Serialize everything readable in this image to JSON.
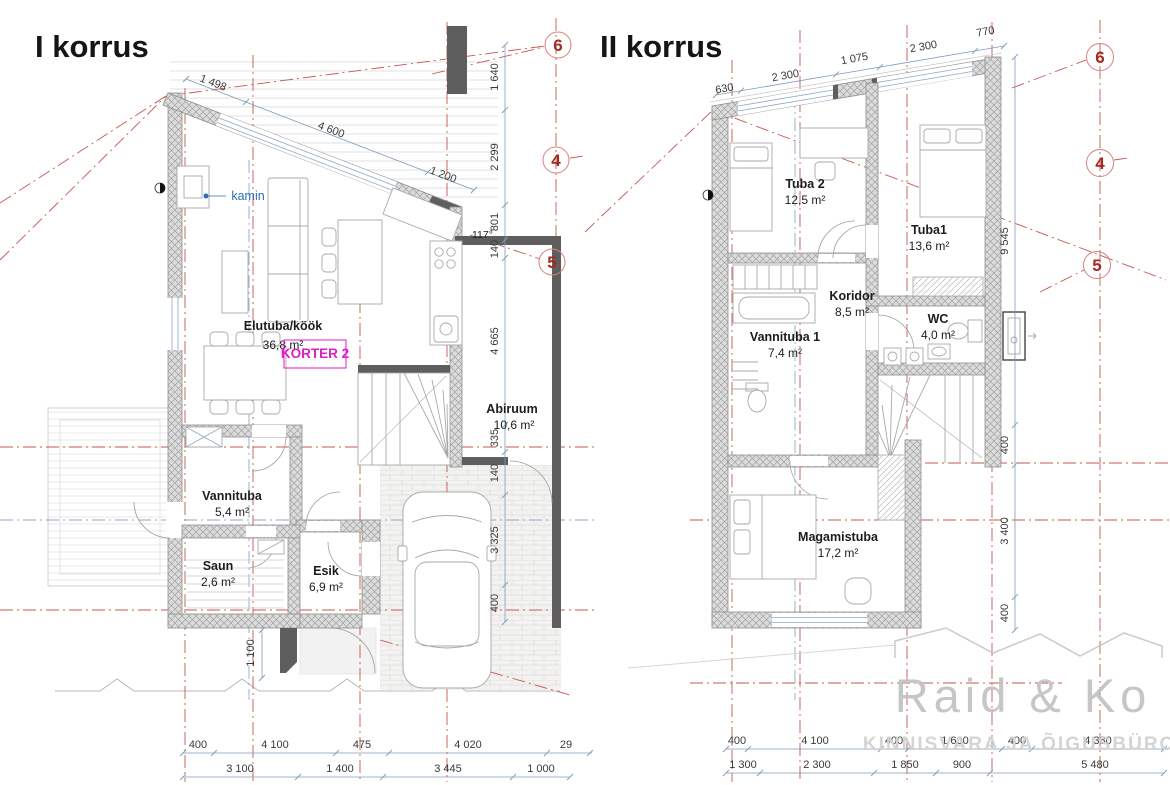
{
  "left": {
    "title": "I korrus",
    "rooms": {
      "elutuba": {
        "name": "Elutuba/köök",
        "area": "36,8 m²"
      },
      "abiruum": {
        "name": "Abiruum",
        "area": "10,6 m²"
      },
      "vannituba": {
        "name": "Vannituba",
        "area": "5,4 m²"
      },
      "saun": {
        "name": "Saun",
        "area": "2,6 m²"
      },
      "esik": {
        "name": "Esik",
        "area": "6,9 m²"
      }
    },
    "korter_label": "KORTER 2",
    "kamin_label": "kamin",
    "angle_label": "117°",
    "dims_roof": [
      "1 498",
      "4 600",
      "1 200"
    ],
    "dims_right": [
      "1 640",
      "2 299",
      "801",
      "140",
      "4 665",
      "335",
      "140",
      "3 325",
      "400"
    ],
    "dim_side": "1 100",
    "dims_bottom1": [
      "400",
      "4 100",
      "475",
      "4 020",
      "29"
    ],
    "dims_bottom2": [
      "3 100",
      "1 400",
      "3 445",
      "1 000"
    ],
    "bubbles": [
      "6",
      "4",
      "5"
    ]
  },
  "right": {
    "title": "II korrus",
    "rooms": {
      "tuba2": {
        "name": "Tuba 2",
        "area": "12,5 m²"
      },
      "tuba1": {
        "name": "Tuba1",
        "area": "13,6 m²"
      },
      "koridor": {
        "name": "Koridor",
        "area": "8,5 m²"
      },
      "wc": {
        "name": "WC",
        "area": "4,0 m²"
      },
      "vannituba1": {
        "name": "Vannituba 1",
        "area": "7,4 m²"
      },
      "magamistuba": {
        "name": "Magamistuba",
        "area": "17,2 m²"
      }
    },
    "dims_top": [
      "630",
      "2 300",
      "1 075",
      "2 300",
      "770"
    ],
    "dims_right": [
      "9 545",
      "400",
      "3 400",
      "400"
    ],
    "dims_bottom1": [
      "400",
      "4 100",
      "400",
      "1 600",
      "400",
      "4 380"
    ],
    "dims_bottom2": [
      "1 300",
      "2 300",
      "1 850",
      "900",
      "5 480"
    ],
    "bubbles": [
      "6",
      "4",
      "5"
    ]
  },
  "watermark": {
    "name": "Raid & Ko",
    "tagline": "KINNISVARA JA ÕIGUSBÜROO"
  },
  "colors": {
    "wall_hatch": "#dcdcdc",
    "wall_dark": "#5e5e5e",
    "grid_red": "#c4584e",
    "bubble_red": "#a32b22",
    "dim_blue": "#7f9cb8",
    "korter_magenta": "#e01ec8",
    "kamin_blue": "#2d6fb8",
    "watermark_gray": "#c3c3c3"
  }
}
